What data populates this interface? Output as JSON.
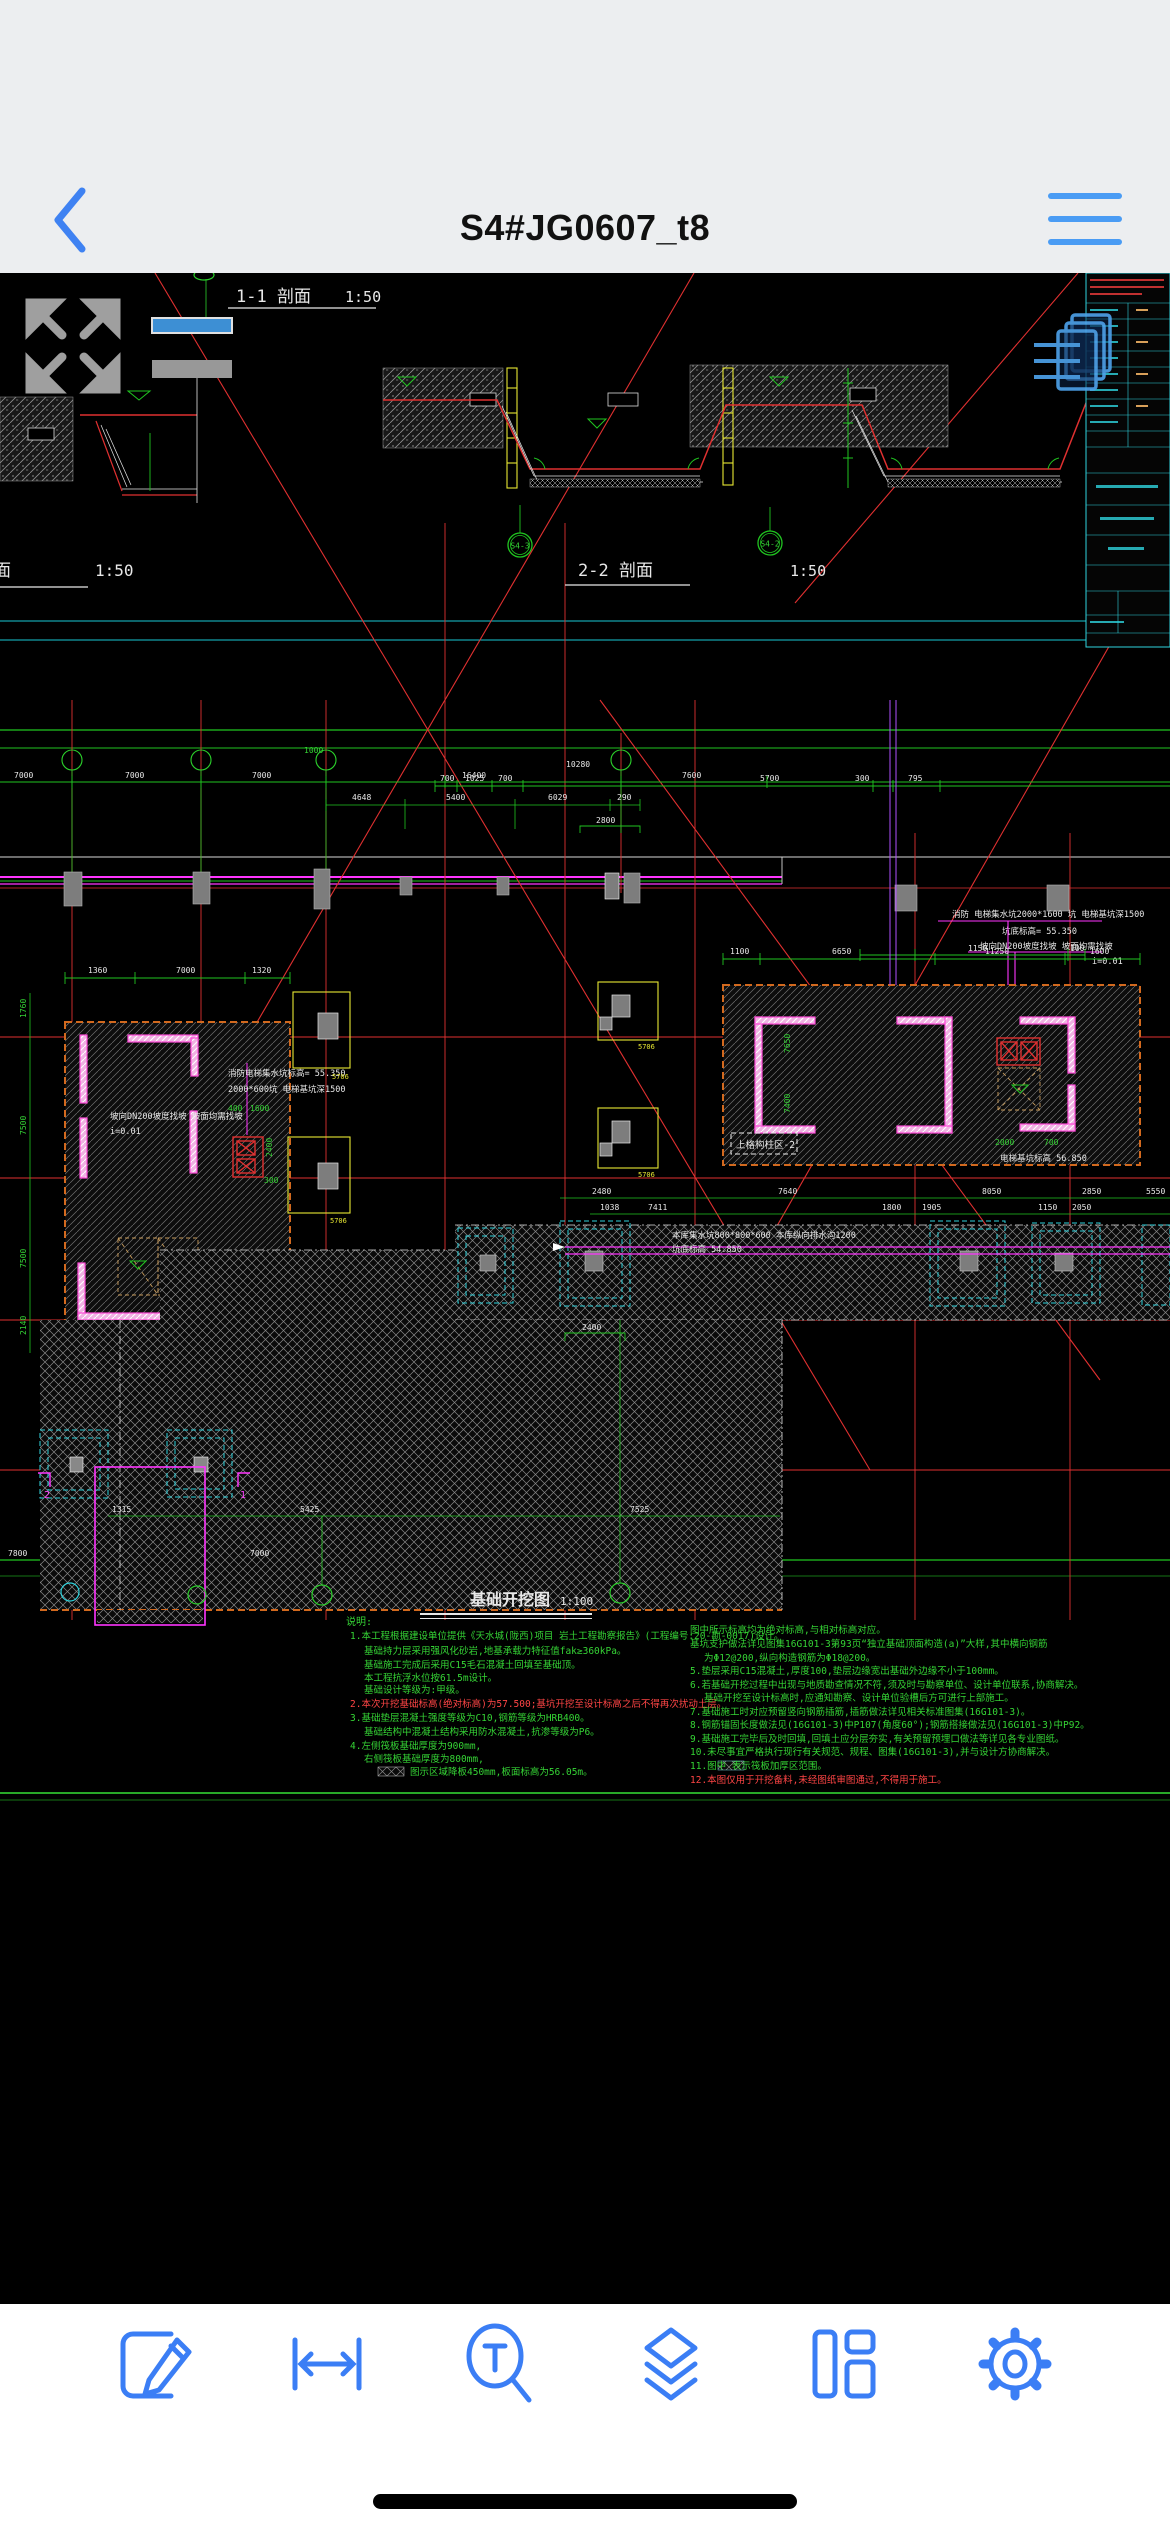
{
  "nav": {
    "title": "S4#JG0607_t8"
  },
  "toolbar": {
    "icons": [
      "annotate",
      "measure",
      "find-text",
      "layers",
      "layouts",
      "settings"
    ]
  },
  "colors": {
    "accent_blue": "#3b7ef5",
    "nav_bg": "#eceef0",
    "cad_green": "#35d435",
    "cad_red": "#e03030",
    "cad_cyan": "#2fd4de",
    "cad_magenta": "#ff35ff",
    "cad_yellow": "#e8e832",
    "cad_orange": "#d2691e",
    "wall_pink": "#f2b6e6"
  },
  "drawing": {
    "sections": {
      "s11_label": "1-1 剖面",
      "s11_scale": "1:50",
      "s22_label": "2-2 剖面",
      "s22_scale": "1:50",
      "left_partial_label": "面",
      "left_partial_scale": "1:50",
      "plan_label": "基础开挖图",
      "plan_scale": "1:100"
    },
    "bubbles": {
      "s22_left": "S4-3",
      "s22_right": "S4-2",
      "grid_hint": "1000"
    },
    "labels": {
      "zone1": "上格构柱区-1",
      "zone2": "上格构柱区-2",
      "pitL_note1": "消防电梯集水坑标高= 55.350",
      "pitL_note2": "2000*600坑 电梯基坑深1500",
      "pitL_note3": "坡向DN200坡度找坡 坡面均需找坡",
      "pitL_note4": "i=0.01",
      "pitR_note1": "消防 电梯集水坑2000*1600 坑 电梯基坑深1500",
      "pitR_note2": "坑底标高= 55.350",
      "pitR_note3": "坡向DN200坡度找坡 坡面均需找坡",
      "pitR_note4": "i=0.01",
      "elev_note": "电梯基坑标高 56.850",
      "sump_note1": "本库集水坑800*800*600 本库纵向排水沟1200",
      "sump_note2": "坑底标高 54.850",
      "cap_tag": "5706"
    },
    "dims": {
      "grid_top": [
        "7000",
        "7000",
        "7000",
        "16400",
        "7600"
      ],
      "grid_total": "10280",
      "grid_sub": [
        "4648",
        "5400",
        "6029",
        "290"
      ],
      "grid_sub2": "2800",
      "s22_bottom": [
        "700",
        "1025",
        "700",
        "5700",
        "300",
        "795"
      ],
      "pitL_top": [
        "1360",
        "7000",
        "1320"
      ],
      "pitL_side": [
        "1760",
        "7500",
        "7500",
        "2140"
      ],
      "pitL_inner": [
        "1400",
        "300",
        "1400",
        "350"
      ],
      "pitL_misc": [
        "400",
        "1600",
        "2400",
        "300"
      ],
      "pitR_top": [
        "1100",
        "6650",
        "11250",
        "1600"
      ],
      "pitR_inner": [
        "7650",
        "7400",
        "2000",
        "700"
      ],
      "pitR_row": [
        "1150",
        "100"
      ],
      "stripA": [
        "2480",
        "7640",
        "8050",
        "2850"
      ],
      "stripB": [
        "1038",
        "7411",
        "1800",
        "1905",
        "1150",
        "2050",
        "5550"
      ],
      "raft": [
        "1315",
        "5425",
        "7525",
        "2400"
      ],
      "bottom": [
        "7800",
        "7000"
      ]
    },
    "notes_title": "说明:",
    "notes_left": [
      "1.本工程根据建设单位提供《天水城(陇西)项目 岩土工程勘察报告》(工程编号:20-勘-0017)设计。",
      "基础持力层采用强风化砂岩,地基承载力特征值fak≥360kPa。",
      "基础施工完成后采用C15毛石混凝土回填至基础顶。",
      "本工程抗浮水位按61.5m设计。",
      "基础设计等级为:甲级。",
      "2.本次开挖基础标高(绝对标高)为57.500;基坑开挖至设计标高之后不得再次扰动土层。",
      "3.基础垫层混凝土强度等级为C10,钢筋等级为HRB400。",
      "基础结构中混凝土结构采用防水混凝土,抗渗等级为P6。",
      "4.左侧筏板基础厚度为900mm,",
      "右侧筏板基础厚度为800mm,",
      "图示区域降板450mm,板面标高为56.05m。"
    ],
    "notes_right": [
      "图中所示标高均为绝对标高,与相对标高对应。",
      "基坑支护做法详见图集16G101-3第93页“独立基础顶面构造(a)”大样,其中横向钢筋",
      "为Φ12@200,纵向构造钢筋为Φ18@200。",
      "5.垫层采用C15混凝土,厚度100,垫层边缘宽出基础外边缘不小于100mm。",
      "6.若基础开挖过程中出现与地质勘查情况不符,须及时与勘察单位、设计单位联系,协商解决。",
      "基础开挖至设计标高时,应通知勘察、设计单位验槽后方可进行上部施工。",
      "7.基础施工时对应预留竖向钢筋插筋,插筋做法详见相关标准图集(16G101-3)。",
      "8.钢筋锚固长度做法见(16G101-3)中P107(角度60°);钢筋搭接做法见(16G101-3)中P92。",
      "9.基础施工完毕后及时回填,回填土应分层夯实,有关预留预埋口做法等详见各专业图纸。",
      "10.未尽事宜严格执行现行有关规范、规程、图集(16G101-3),并与设计方协商解决。",
      "11.图中 表示筏板加厚区范围。",
      "12.本图仅用于开挖备料,未经图纸审图通过,不得用于施工。"
    ]
  }
}
